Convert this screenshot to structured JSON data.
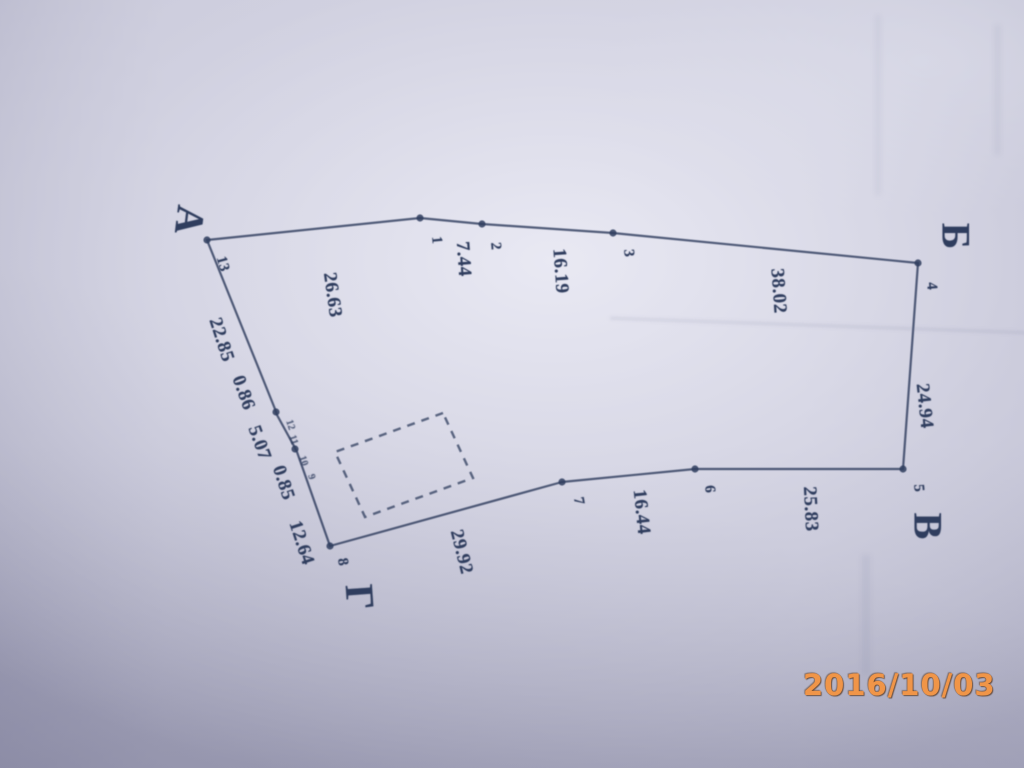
{
  "plan": {
    "ink_color": "#2f3d5e",
    "outline": [
      [
        207,
        240
      ],
      [
        420,
        218
      ],
      [
        482,
        224
      ],
      [
        613,
        233
      ],
      [
        918,
        263
      ],
      [
        903,
        469
      ],
      [
        695,
        469
      ],
      [
        562,
        482
      ],
      [
        330,
        546
      ],
      [
        297,
        452
      ],
      [
        294,
        446
      ],
      [
        277,
        415
      ],
      [
        275,
        409
      ]
    ],
    "dots": [
      [
        207,
        240
      ],
      [
        420,
        218
      ],
      [
        482,
        224
      ],
      [
        613,
        233
      ],
      [
        918,
        263
      ],
      [
        903,
        469
      ],
      [
        695,
        469
      ],
      [
        562,
        482
      ],
      [
        330,
        546
      ],
      [
        295,
        449
      ],
      [
        276,
        412
      ]
    ],
    "building": [
      [
        443,
        413
      ],
      [
        335,
        452
      ],
      [
        365,
        517
      ],
      [
        473,
        478
      ]
    ],
    "corner_letters": [
      {
        "text": "А",
        "x": 190,
        "y": 220,
        "rot": 97
      },
      {
        "text": "Б",
        "x": 956,
        "y": 236,
        "rot": 90
      },
      {
        "text": "В",
        "x": 928,
        "y": 526,
        "rot": 90
      },
      {
        "text": "Г",
        "x": 360,
        "y": 597,
        "rot": 86
      }
    ],
    "point_labels": [
      {
        "text": "1",
        "x": 436,
        "y": 240,
        "rot": 85
      },
      {
        "text": "2",
        "x": 495,
        "y": 246,
        "rot": 85
      },
      {
        "text": "3",
        "x": 628,
        "y": 253,
        "rot": 85
      },
      {
        "text": "4",
        "x": 931,
        "y": 286,
        "rot": 85
      },
      {
        "text": "5",
        "x": 918,
        "y": 488,
        "rot": 85
      },
      {
        "text": "6",
        "x": 709,
        "y": 489,
        "rot": 85
      },
      {
        "text": "7",
        "x": 578,
        "y": 501,
        "rot": 80
      },
      {
        "text": "8",
        "x": 342,
        "y": 562,
        "rot": 80
      },
      {
        "text": "13",
        "x": 222,
        "y": 264,
        "rot": 75
      }
    ],
    "tiny_point_labels": [
      {
        "text": "12",
        "x": 290,
        "y": 425,
        "rot": 72
      },
      {
        "text": "11",
        "x": 293,
        "y": 440,
        "rot": 72
      },
      {
        "text": "10",
        "x": 303,
        "y": 461,
        "rot": 72
      },
      {
        "text": "9",
        "x": 311,
        "y": 477,
        "rot": 72
      }
    ],
    "edge_labels": [
      {
        "text": "26.63",
        "x": 332,
        "y": 295,
        "rot": 82
      },
      {
        "text": "7.44",
        "x": 463,
        "y": 259,
        "rot": 86
      },
      {
        "text": "16.19",
        "x": 560,
        "y": 271,
        "rot": 86
      },
      {
        "text": "38.02",
        "x": 778,
        "y": 291,
        "rot": 86
      },
      {
        "text": "24.94",
        "x": 924,
        "y": 406,
        "rot": 84
      },
      {
        "text": "25.83",
        "x": 810,
        "y": 509,
        "rot": 87
      },
      {
        "text": "16.44",
        "x": 641,
        "y": 512,
        "rot": 84
      },
      {
        "text": "29.92",
        "x": 461,
        "y": 552,
        "rot": 76
      },
      {
        "text": "12.64",
        "x": 301,
        "y": 543,
        "rot": 72
      },
      {
        "text": "0.85",
        "x": 283,
        "y": 483,
        "rot": 72
      },
      {
        "text": "5.07",
        "x": 259,
        "y": 443,
        "rot": 70
      },
      {
        "text": "0.86",
        "x": 243,
        "y": 393,
        "rot": 70
      },
      {
        "text": "22.85",
        "x": 221,
        "y": 340,
        "rot": 72
      }
    ]
  },
  "camera": {
    "timestamp": "2016/10/03",
    "stamp_color": "#f09548"
  }
}
